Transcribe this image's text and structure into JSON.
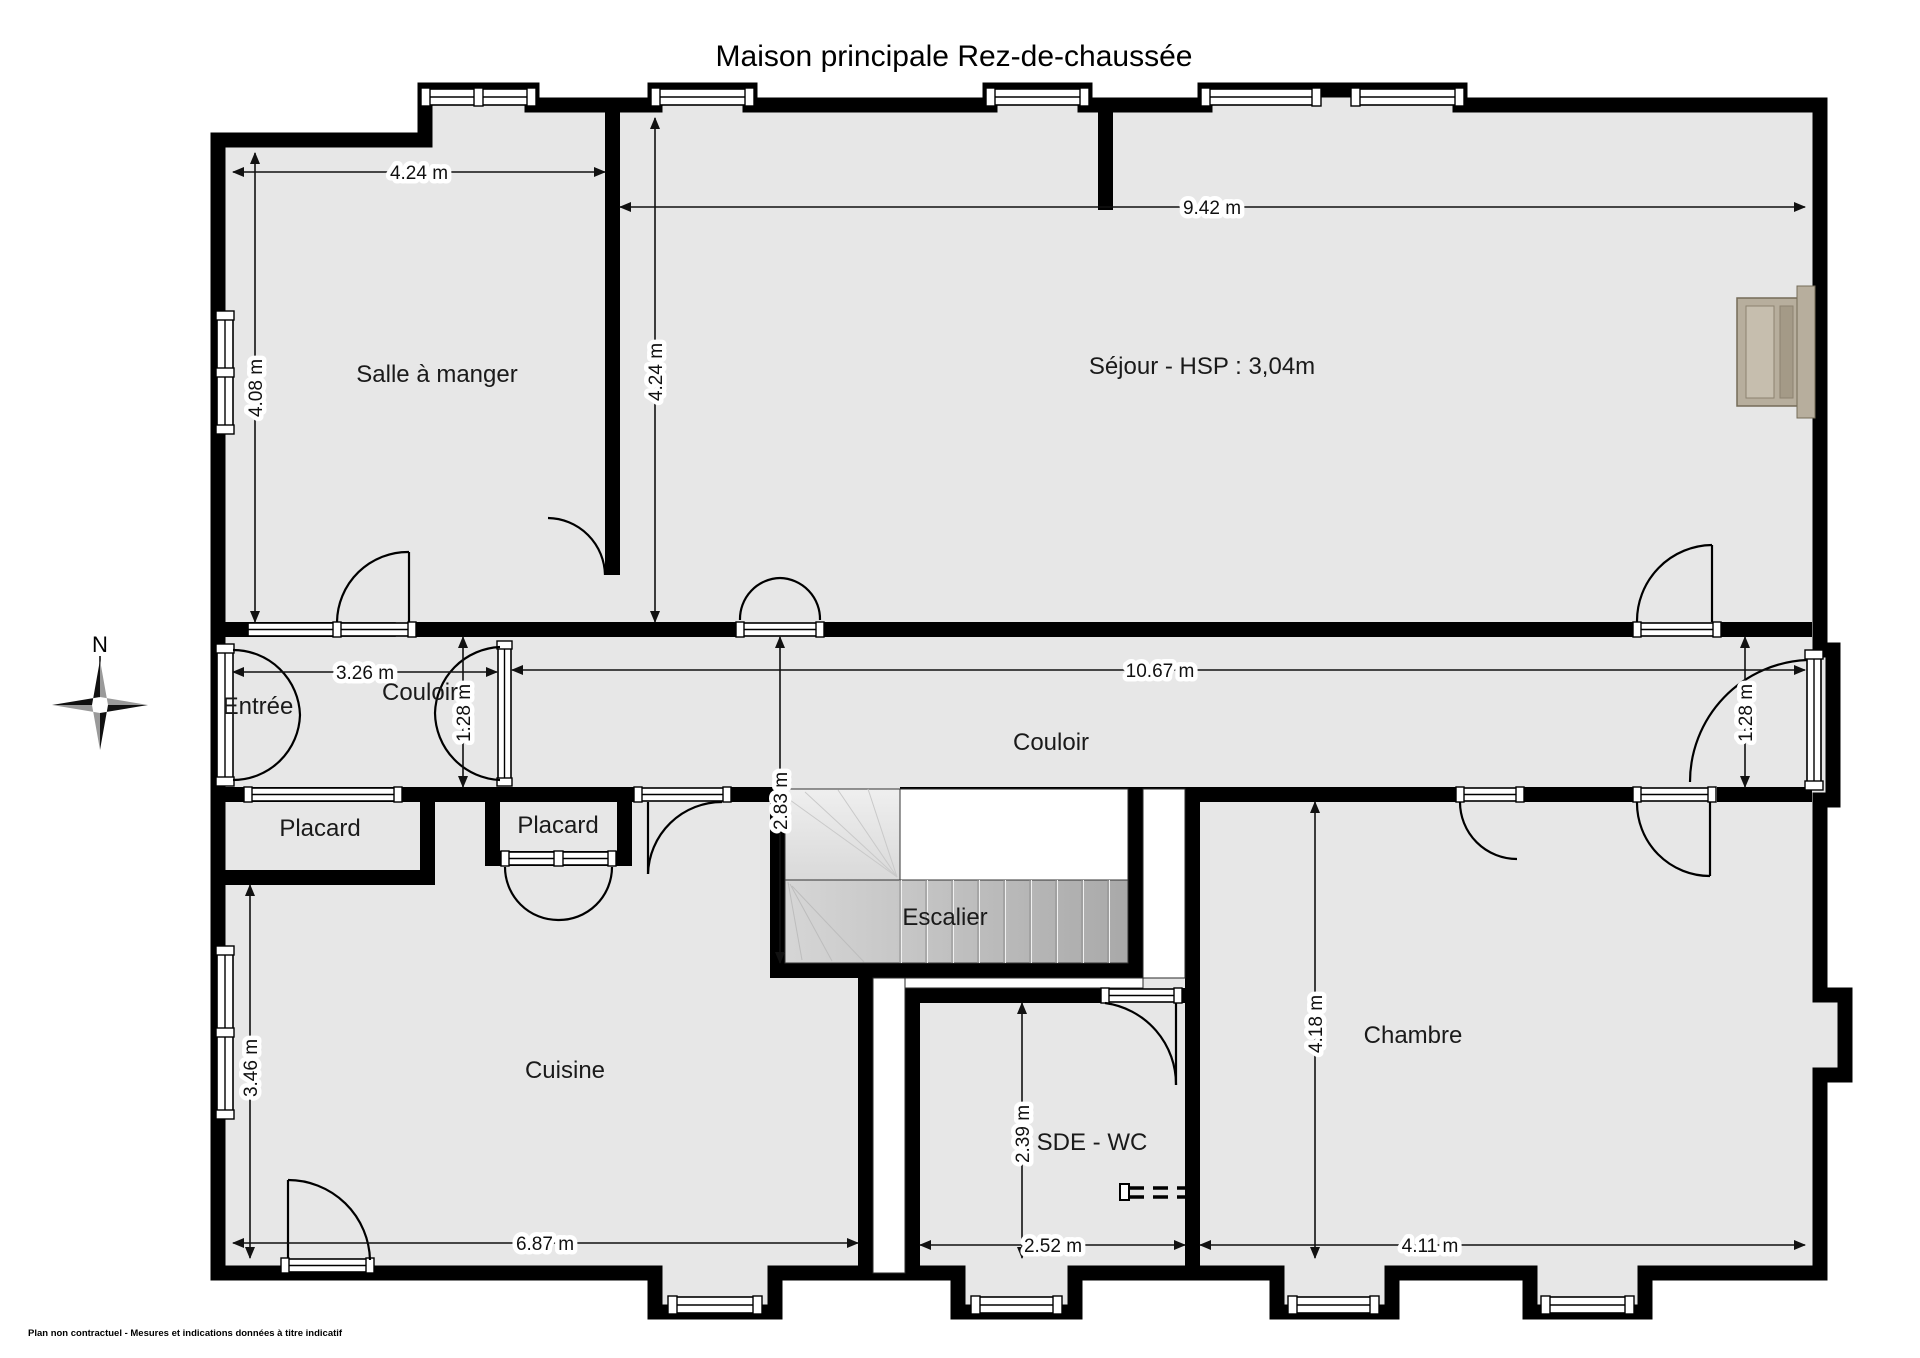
{
  "title": "Maison principale Rez-de-chaussée",
  "compass": {
    "north": "N"
  },
  "rooms": {
    "salle_a_manger": "Salle à manger",
    "sejour": "Séjour - HSP : 3,04m",
    "entree": "Entrée",
    "couloir_ouest": "Couloir",
    "couloir": "Couloir",
    "placard_1": "Placard",
    "placard_2": "Placard",
    "escalier": "Escalier",
    "cuisine": "Cuisine",
    "sde_wc": "SDE - WC",
    "chambre": "Chambre"
  },
  "dimensions": {
    "salle_largeur": "4.24 m",
    "sejour_largeur": "9.42 m",
    "salle_hauteur": "4.08 m",
    "sejour_hauteur": "4.24 m",
    "couloir_ouest_longueur": "3.26 m",
    "couloir_longueur": "10.67 m",
    "couloir_ouest_largeur": "1.28 m",
    "couloir_est_largeur": "1.28 m",
    "escalier_profondeur": "2.83 m",
    "cuisine_hauteur": "3.46 m",
    "cuisine_largeur": "6.87 m",
    "sde_largeur": "2.52 m",
    "sde_hauteur": "2.39 m",
    "chambre_hauteur": "4.18 m",
    "chambre_largeur": "4.11 m"
  },
  "footer": "Plan non contractuel - Mesures et indications données à titre indicatif",
  "colors": {
    "room_fill": "#e7e7e7",
    "wall": "#000000",
    "fireplace": "#b7ae9d"
  }
}
